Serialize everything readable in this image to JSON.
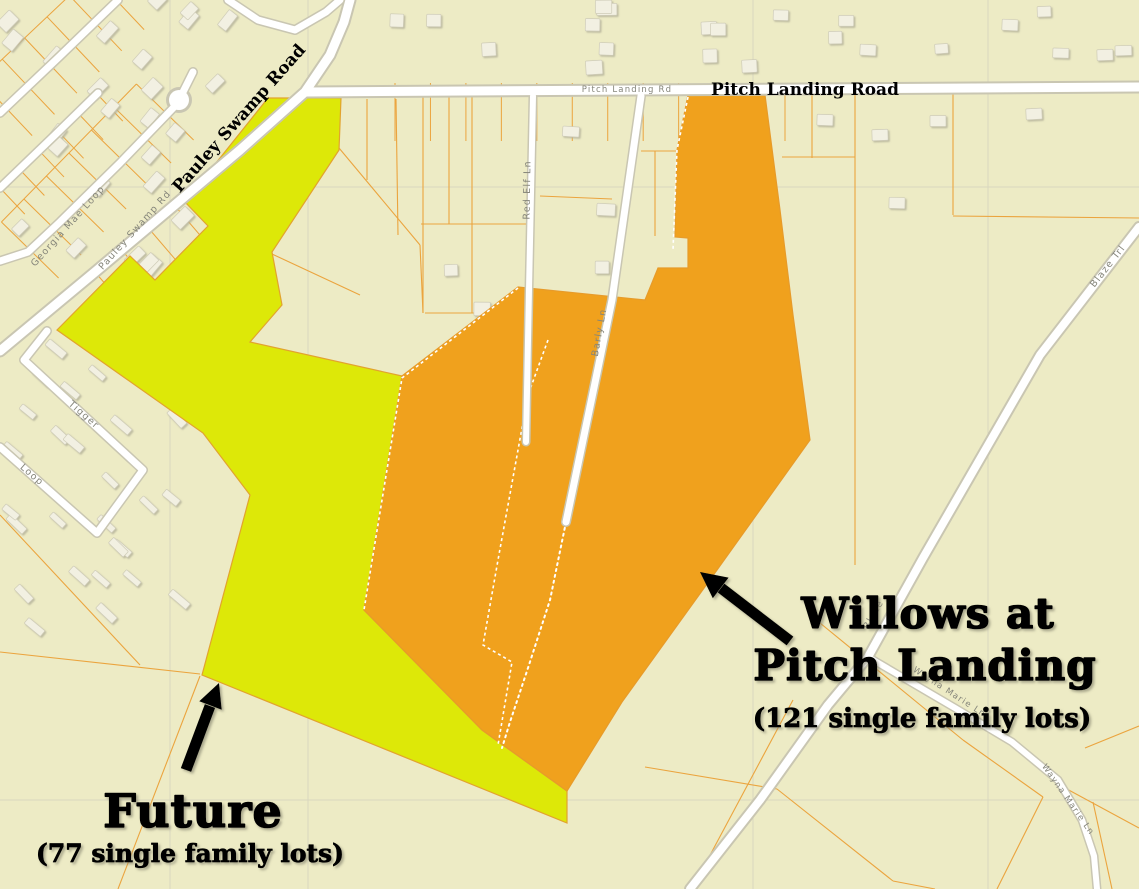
{
  "map": {
    "colors": {
      "background": "#edebc5",
      "parcel_line": "#eba43e",
      "future_fill": "#dde808",
      "future_stroke": "#e2a32e",
      "willows_fill": "#f0a11d",
      "willows_stroke": "#e79b2a",
      "road_fill": "#ffffff",
      "road_casing": "#c9c6b2",
      "road_label": "#85857a",
      "building_fill": "#f2f0e2",
      "annotation_text": "#000000"
    },
    "roads": {
      "pitch_landing_road_large": "Pitch Landing Road",
      "pitch_landing_rd_small": "Pitch Landing Rd",
      "pauley_swamp_road_large": "Pauley Swamp Road",
      "pauley_swamp_rd_small": "Pauley Swamp Rd",
      "georgia_mae_loop": "Georgia Mae Loop",
      "tigger": "Tigger",
      "loop": "Loop",
      "red_elf_ln": "Red Elf Ln",
      "barly_ln": "Barly Ln",
      "blaze_trl": "Blaze Trl",
      "blaze_partial": "Blaze",
      "wayna_marie_ln": "Wayna Marie Ln"
    },
    "annotations": {
      "willows": {
        "line1": "Willows at",
        "line2": "Pitch Landing",
        "sublabel": "(121 single family lots)",
        "lot_count": "121"
      },
      "future": {
        "label": "Future",
        "sublabel": "(77 single family lots)",
        "lot_count": "77"
      }
    }
  }
}
